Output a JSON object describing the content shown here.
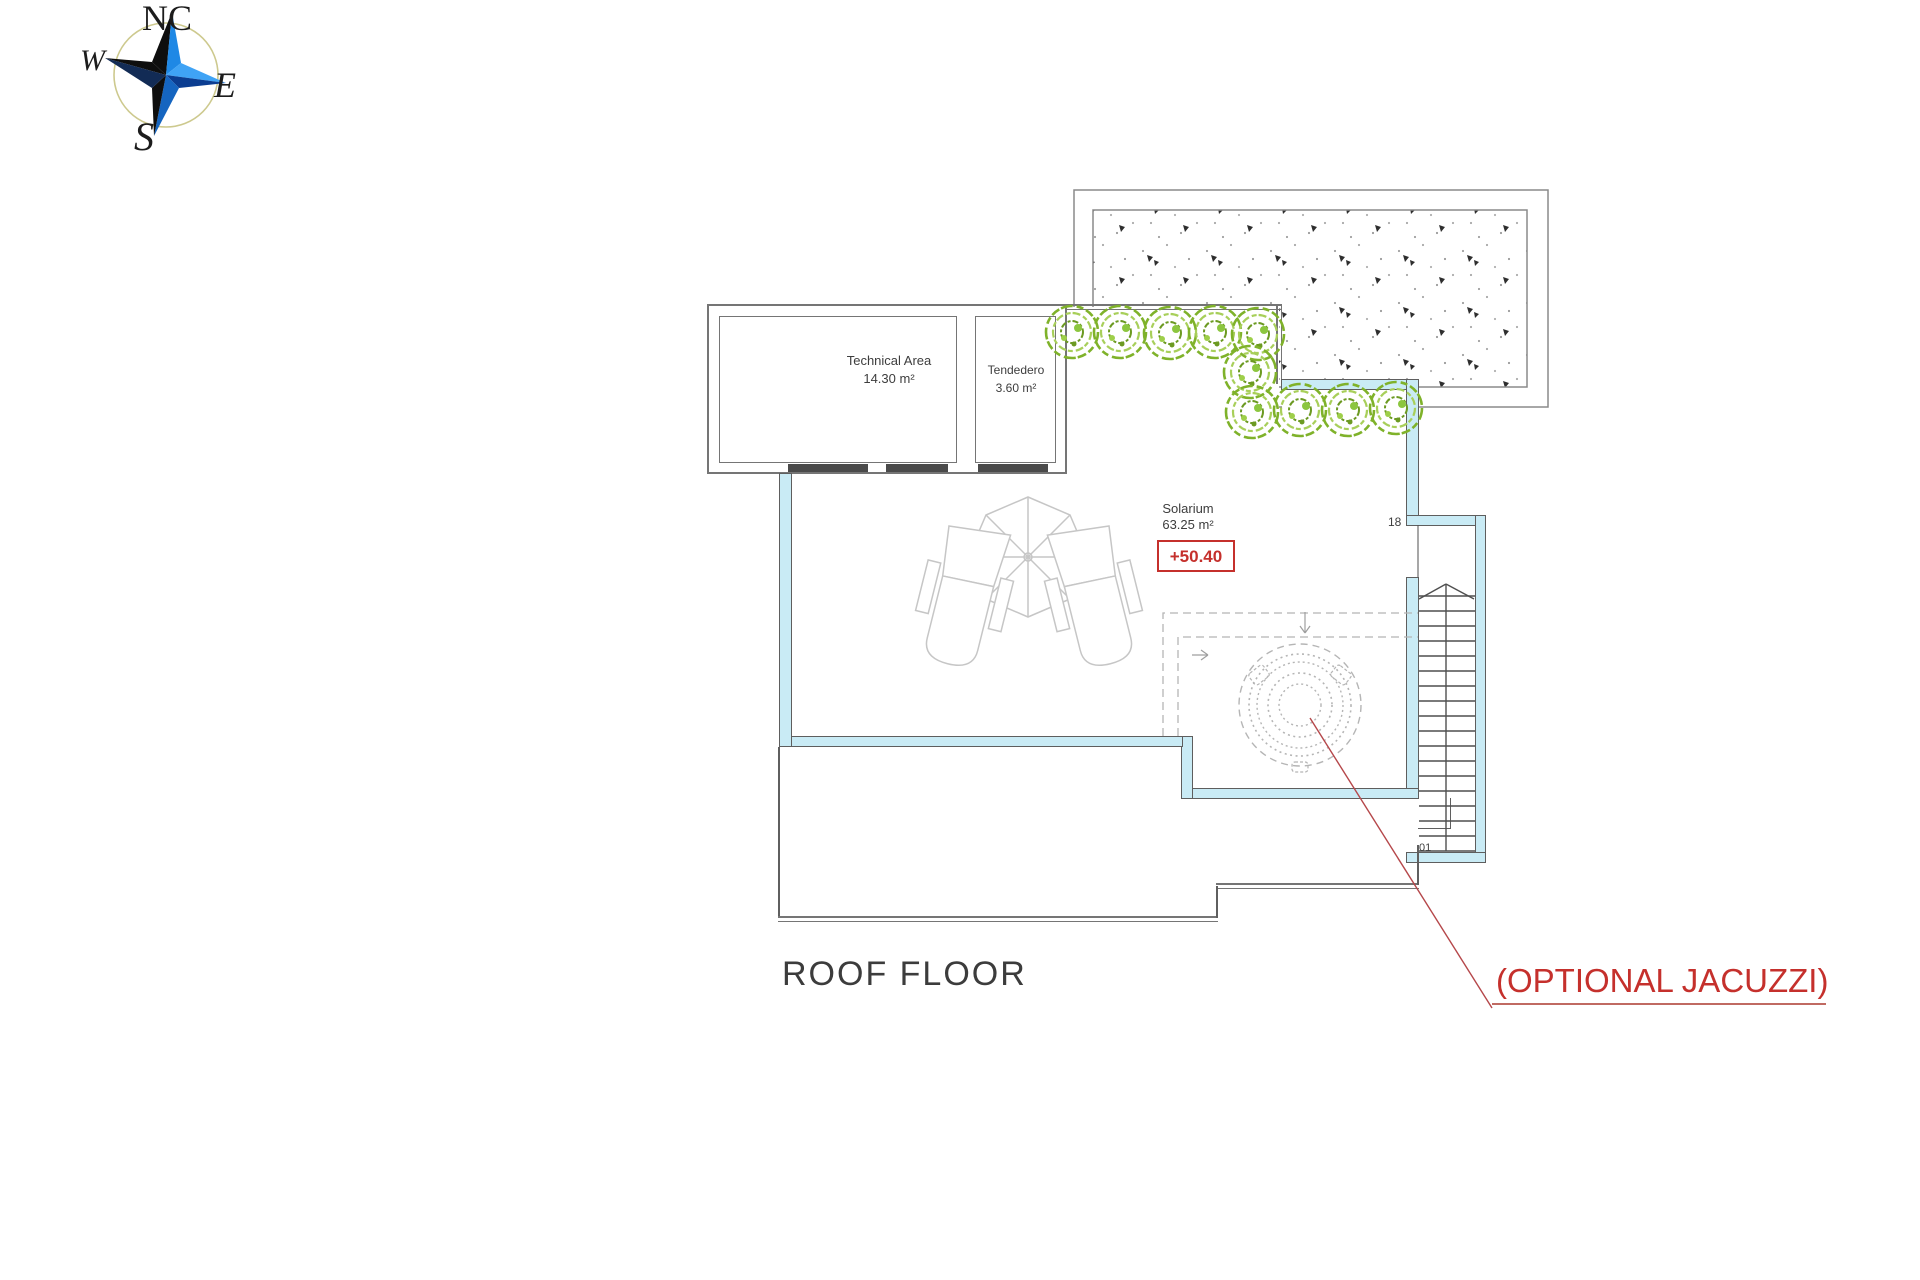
{
  "compass": {
    "north_label": "NC",
    "west_label": "W",
    "east_label": "E",
    "south_label": "S"
  },
  "plan": {
    "title": "ROOF FLOOR",
    "rooms": [
      {
        "id": "technical",
        "name": "Technical Area",
        "area": "14.30 m²"
      },
      {
        "id": "tendedero",
        "name": "Tendedero",
        "area": "3.60 m²"
      },
      {
        "id": "solarium",
        "name": "Solarium",
        "area": "63.25 m²"
      }
    ],
    "level_marker": "+50.40",
    "stair_top": "18",
    "stair_bottom": "01",
    "annotation": "(OPTIONAL JACUZZI)"
  },
  "colors": {
    "wall_fill_cyan": "#c9ebf5",
    "wall_line_gray": "#757575",
    "accent_red": "#c5302c",
    "bush_green_dark": "#6c9a22",
    "bush_green": "#7fb22a",
    "bush_green_light": "#a8cf5a",
    "furniture_gray": "#c6c6c6",
    "compass_blue_bright": "#3fa3f5",
    "compass_blue": "#1e88e5",
    "compass_navy": "#0b3d91",
    "compass_black": "#0e0e0e",
    "compass_ring": "#cdc98e"
  }
}
